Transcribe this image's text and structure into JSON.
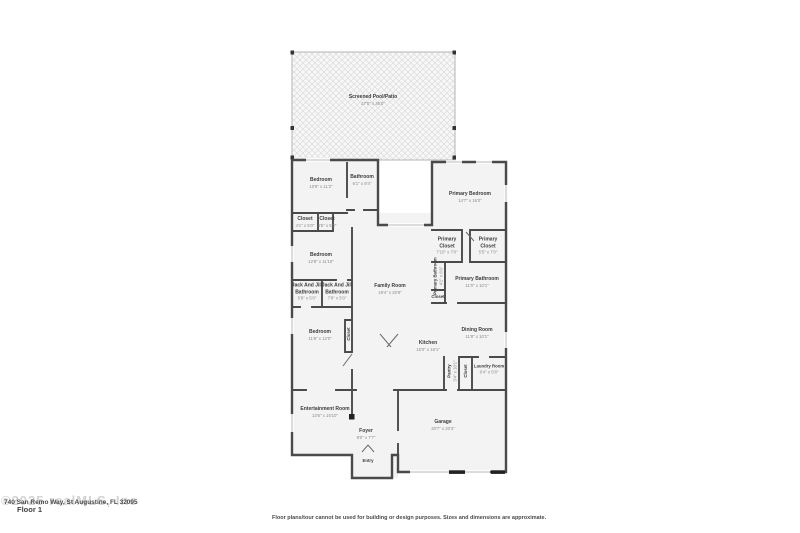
{
  "plan": {
    "rooms": {
      "pool": {
        "name": "Screened Pool/Patio",
        "dims": "27'0\" x 36'0\""
      },
      "bedroom1": {
        "name": "Bedroom",
        "dims": "10'8\" x 11'2\""
      },
      "bathroom1": {
        "name": "Bathroom",
        "dims": "6'1\" x 9'4\""
      },
      "closet1": {
        "name": "Closet",
        "dims": "4'1\" x 5'0\""
      },
      "closet2": {
        "name": "Closet",
        "dims": "4'5\" x 5'0\""
      },
      "bedroom2": {
        "name": "Bedroom",
        "dims": "12'8\" x 11'10\""
      },
      "jackjill1": {
        "name": "Jack And Jill Bathroom",
        "dims": "5'8\" x 5'0\""
      },
      "jackjill2": {
        "name": "Jack And Jill Bathroom",
        "dims": "7'8\" x 5'0\""
      },
      "bedroom3": {
        "name": "Bedroom",
        "dims": "11'8\" x 12'0\""
      },
      "closet3": {
        "name": "Closet"
      },
      "family": {
        "name": "Family Room",
        "dims": "19'4\" x 20'9\""
      },
      "primary_bedroom": {
        "name": "Primary Bedroom",
        "dims": "14'7\" x 16'0\""
      },
      "primary_closet1": {
        "name": "Primary Closet",
        "dims": "7'10\" x 7'0\""
      },
      "primary_closet2": {
        "name": "Primary Closet",
        "dims": "5'5\" x 7'0\""
      },
      "primary_bath_wc": {
        "name": "Primary Bathroom",
        "dims": "4'1\" x 6'0\""
      },
      "closet4": {
        "name": "Closet"
      },
      "primary_bathroom": {
        "name": "Primary Bathroom",
        "dims": "11'0\" x 10'1\""
      },
      "kitchen": {
        "name": "Kitchen",
        "dims": "15'0\" x 16'1\""
      },
      "dining": {
        "name": "Dining Room",
        "dims": "11'8\" x 10'1\""
      },
      "pantry": {
        "name": "Pantry",
        "dims": "3'4\" x 10'1\""
      },
      "closet5": {
        "name": "Closet"
      },
      "laundry": {
        "name": "Laundry Room",
        "dims": "6'4\" x 5'8\""
      },
      "entertainment": {
        "name": "Entertainment Room",
        "dims": "13'6\" x 15'10\""
      },
      "foyer": {
        "name": "Foyer",
        "dims": "8'0\" x 7'7\""
      },
      "entry": {
        "name": "Entry"
      },
      "garage": {
        "name": "Garage",
        "dims": "20'7\" x 20'3\""
      }
    },
    "footer": {
      "watermark": "©2025 realMLS, Inc",
      "address": "740 San Remo Way, St Augustine, FL 32095",
      "floor": "Floor 1",
      "disclaimer": "Floor plans/tour cannot be used for building or design purposes. Sizes and dimensions are approximate."
    },
    "colors": {
      "wall": "#4a4a4a",
      "room_fill": "#f3f3f3",
      "hatch_line": "#dcdcdc",
      "dim_text": "#8a8a8a"
    }
  }
}
